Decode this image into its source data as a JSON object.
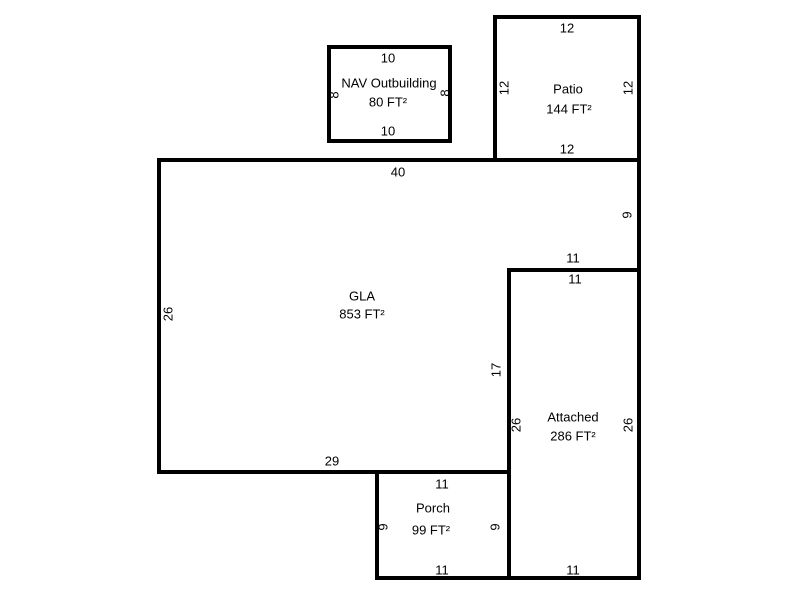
{
  "colors": {
    "wall": "#000000",
    "background": "#ffffff",
    "text": "#000000"
  },
  "sketch": {
    "outbuilding": {
      "name": "NAV Outbuilding",
      "area": "80 FT²",
      "dim_top": "10",
      "dim_bottom": "10",
      "dim_left": "8",
      "dim_right": "8"
    },
    "patio": {
      "name": "Patio",
      "area": "144 FT²",
      "dim_top": "12",
      "dim_bottom": "12",
      "dim_left": "12",
      "dim_right": "12"
    },
    "gla": {
      "name": "GLA",
      "area": "853 FT²",
      "dim_top": "40",
      "dim_left": "26",
      "dim_right_upper": "9",
      "dim_notch_top": "11",
      "dim_inner_right": "17",
      "dim_bottom": "29"
    },
    "attached": {
      "name": "Attached",
      "area": "286 FT²",
      "dim_top": "11",
      "dim_bottom": "11",
      "dim_left": "26",
      "dim_right": "26"
    },
    "porch": {
      "name": "Porch",
      "area": "99 FT²",
      "dim_top": "11",
      "dim_bottom": "11",
      "dim_left": "9",
      "dim_right": "9"
    }
  }
}
